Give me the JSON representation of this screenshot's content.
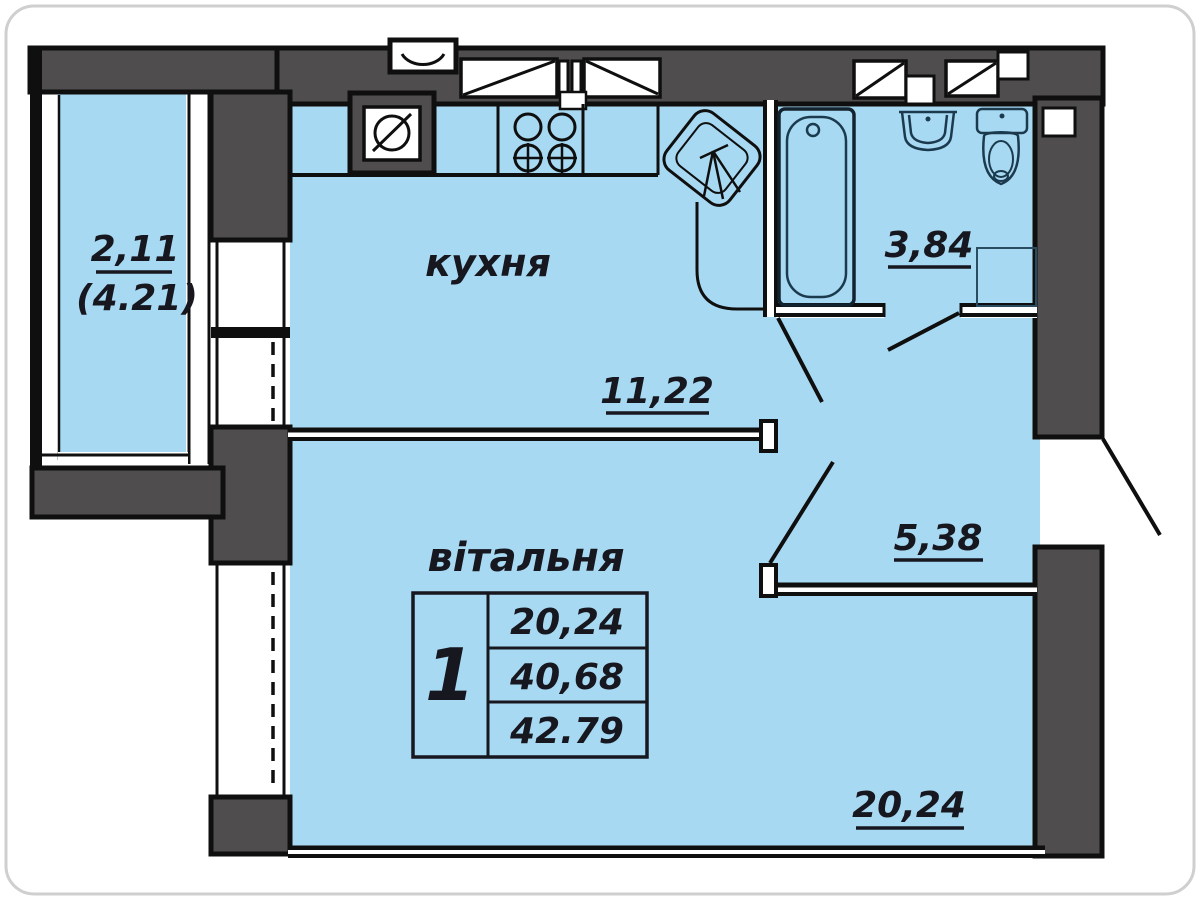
{
  "plan_type": "apartment floor plan",
  "colors": {
    "room_fill": "#a8d9f2",
    "wall_fill": "#4f4d4e",
    "outline": "#0f0f0f",
    "fixture_stroke": "#1b3a4e",
    "text": "#17171f",
    "card_border": "#cfcfcf"
  },
  "rooms": {
    "balcony": {
      "area_coeff": "2,11",
      "area_full": "(4.21)"
    },
    "kitchen": {
      "name": "кухня",
      "area": "11,22"
    },
    "bathroom": {
      "area": "3,84"
    },
    "hall": {
      "area": "5,38"
    },
    "living": {
      "name": "вітальня",
      "area": "20,24"
    }
  },
  "summary_table": {
    "rooms_count": "1",
    "living_area": "20,24",
    "area_without_balcony": "40,68",
    "total_area": "42.79"
  }
}
